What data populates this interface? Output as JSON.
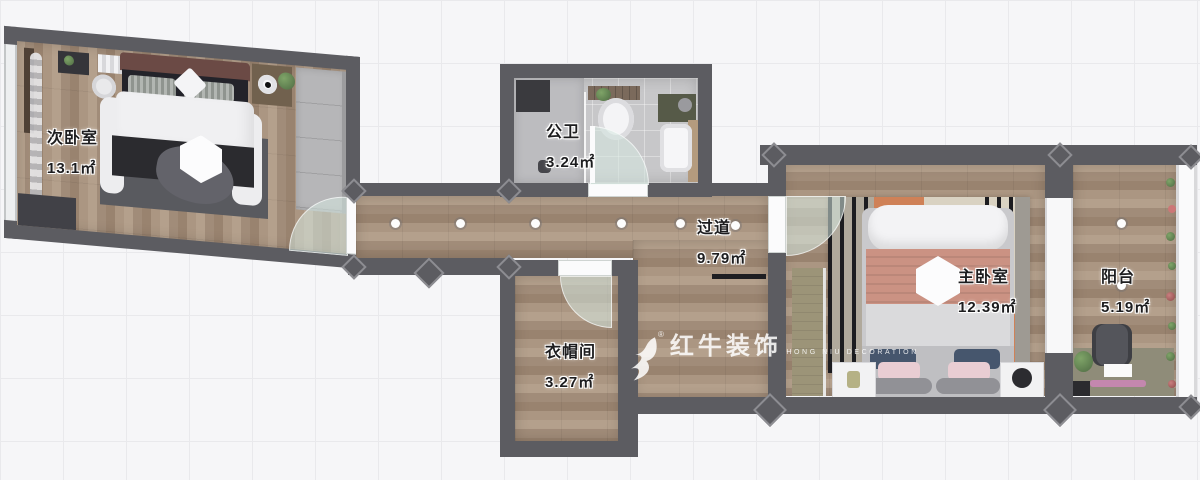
{
  "plan_title": "apartment-floor-plan",
  "rooms": [
    {
      "id": "secondary-bedroom",
      "name": "次卧室",
      "area": "13.1㎡"
    },
    {
      "id": "bathroom",
      "name": "公卫",
      "area": "3.24㎡"
    },
    {
      "id": "hallway",
      "name": "过道",
      "area": "9.79㎡"
    },
    {
      "id": "cloakroom",
      "name": "衣帽间",
      "area": "3.27㎡"
    },
    {
      "id": "master-bedroom",
      "name": "主卧室",
      "area": "12.39㎡"
    },
    {
      "id": "balcony",
      "name": "阳台",
      "area": "5.19㎡"
    }
  ],
  "watermark": {
    "brand": "红牛装饰",
    "registered": "®",
    "subtitle": "HONG NIU DECORATION"
  },
  "colors": {
    "wall": "#5c5c61",
    "wood": "#a8937f",
    "bath_tile": "#c7c7c9",
    "rug_orange": "#cf8157",
    "bed_salmon": "#cb9283",
    "glass": "#d5e8e0",
    "navy_pillow": "#46566d",
    "pink_pillow": "#e9cdd3",
    "background": "#f6f6f8"
  }
}
